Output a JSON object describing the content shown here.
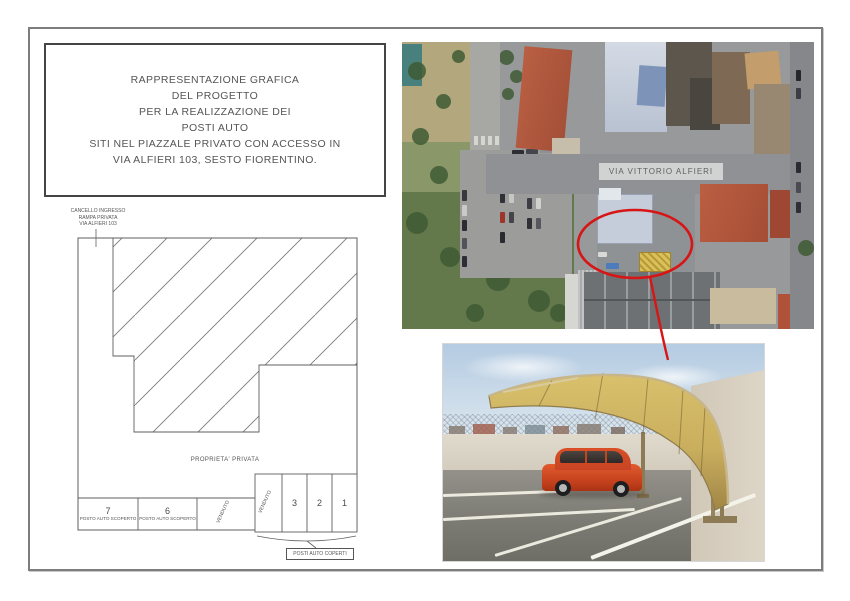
{
  "title_box": {
    "lines": [
      "RAPPRESENTAZIONE GRAFICA",
      "DEL PROGETTO",
      "PER LA REALIZZAZIONE DEI",
      "POSTI AUTO",
      "SITI NEL PIAZZALE PRIVATO CON ACCESSO IN",
      "VIA ALFIERI 103, SESTO FIORENTINO."
    ]
  },
  "site_plan": {
    "gate_label_lines": [
      "CANCELLO INGRESSO",
      "RAMPA PRIVATA",
      "VIA ALFIERI 103"
    ],
    "property_label": "PROPRIETA' PRIVATA",
    "uncovered_stalls": [
      {
        "number": "7",
        "label": "POSTO AUTO SCOPERTO"
      },
      {
        "number": "6",
        "label": "POSTO AUTO SCOPERTO"
      },
      {
        "number": "VENDUTO",
        "label": ""
      }
    ],
    "covered_stalls": [
      "VENDUTO",
      "3",
      "2",
      "1"
    ],
    "covered_caption": "POSTI AUTO COPERTI"
  },
  "aerial_map": {
    "street_label": "VIA VITTORIO ALFIERI",
    "highlight_color": "#d81515"
  },
  "colors": {
    "plan_line": "#5f5f5f",
    "page_border": "#7d7d7d",
    "canopy_gold": "#c9ae5e",
    "car_red": "#d6492a"
  }
}
